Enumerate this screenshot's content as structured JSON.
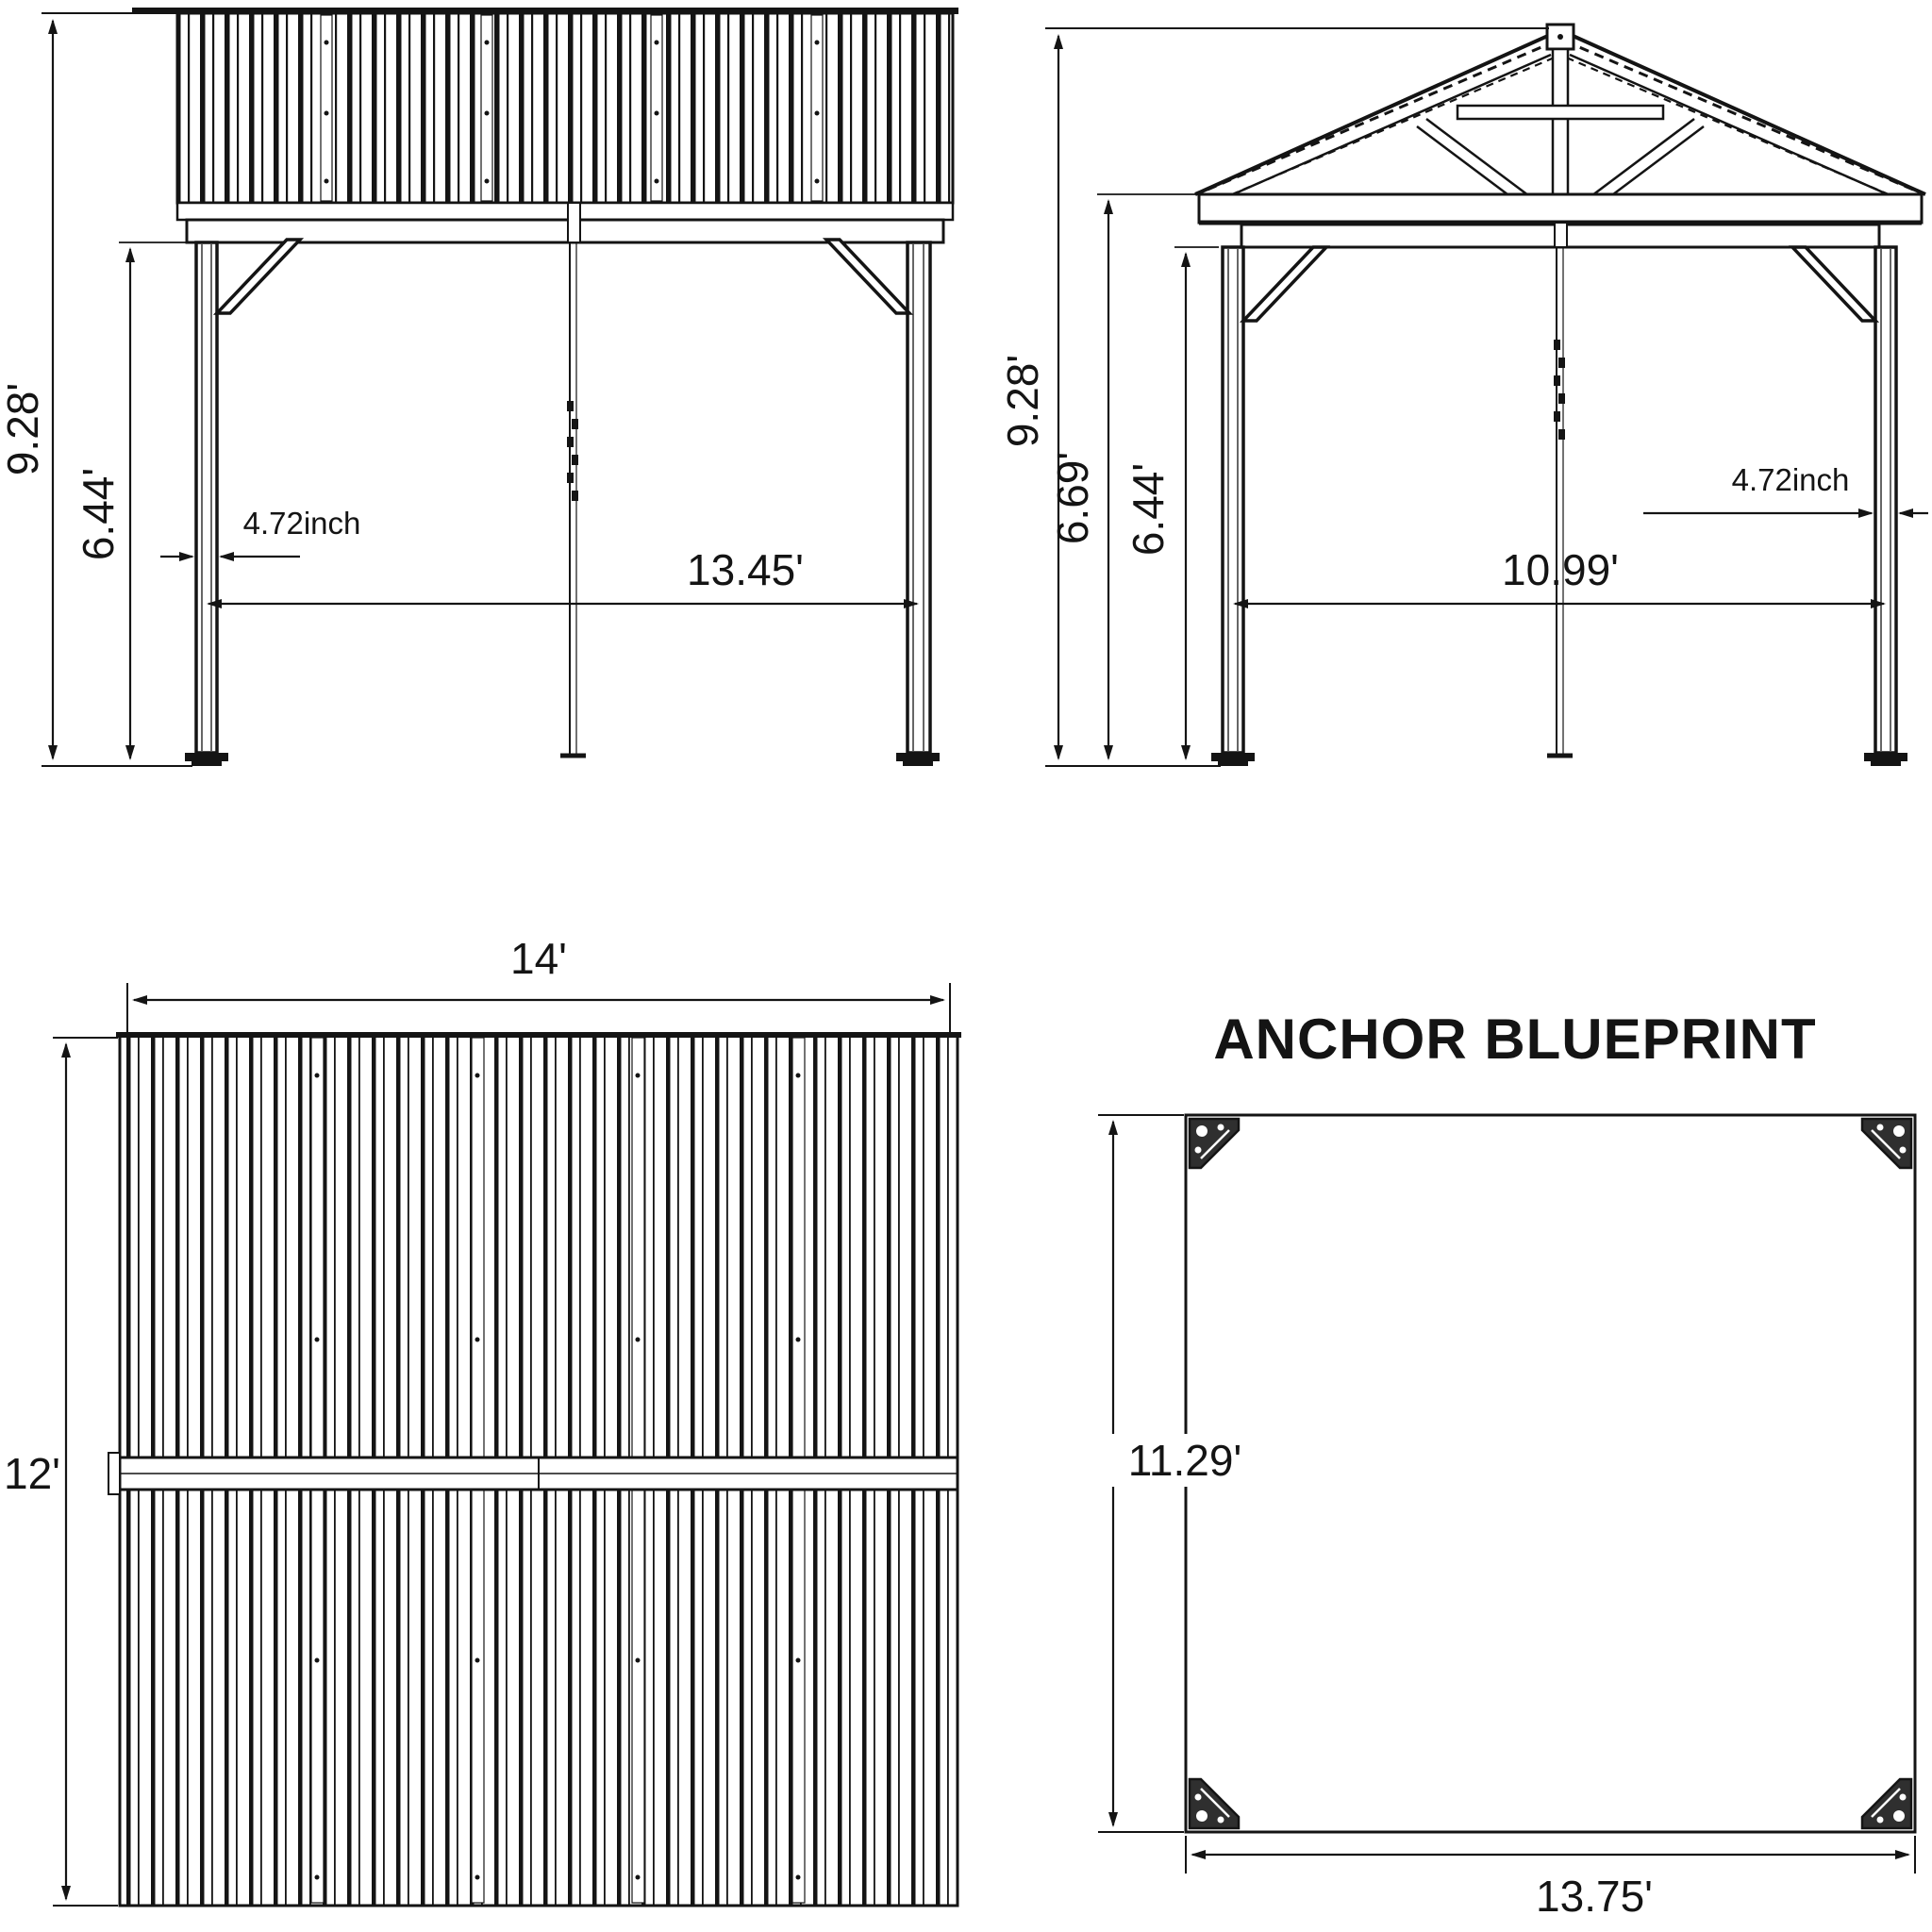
{
  "drawing": {
    "type": "gazebo-assembly-blueprint",
    "ink_color": "#141414",
    "background_color": "#ffffff"
  },
  "views": {
    "side_elevation": {
      "total_height": "9.28'",
      "post_height": "6.44'",
      "post_width": "4.72inch",
      "span": "13.45'"
    },
    "front_elevation": {
      "total_height": "9.28'",
      "eave_height": "6.69'",
      "post_height": "6.44'",
      "post_width": "4.72inch",
      "span": "10.99'"
    },
    "roof_top_view": {
      "width": "14'",
      "depth": "12'"
    },
    "anchor_blueprint": {
      "title": "ANCHOR BLUEPRINT",
      "depth": "11.29'",
      "width": "13.75'"
    }
  }
}
